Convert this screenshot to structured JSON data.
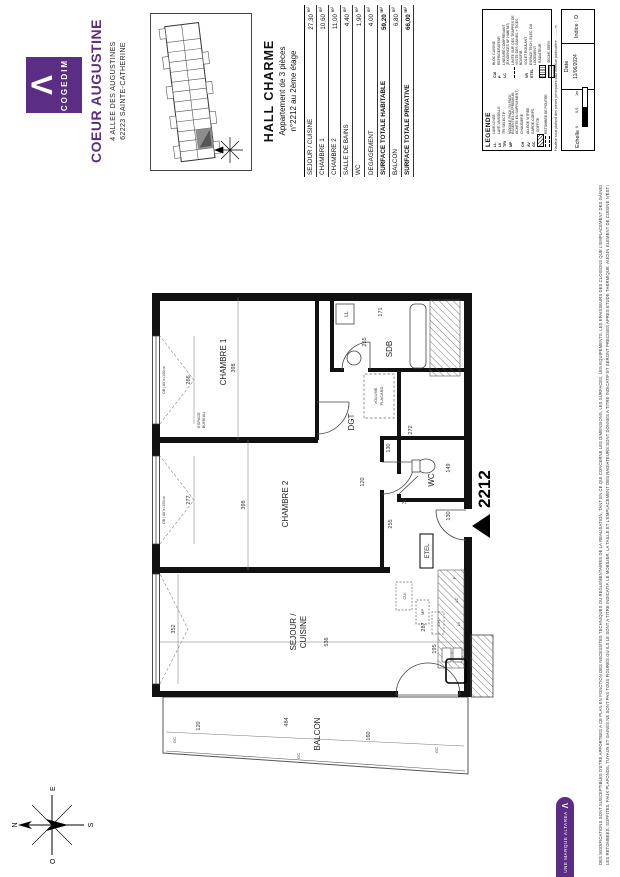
{
  "brand": {
    "name": "COGEDIM",
    "logo_glyph": "Λ",
    "residence": "COEUR AUGUSTINE",
    "address1": "4 ALLEE DES AUGUSTINES",
    "address2": "62223 SAINTE-CATHERINE",
    "ribbon": "UNE MARQUE ALTAREA",
    "accent": "#5b2d85"
  },
  "apartment": {
    "hall": "HALL CHARME",
    "type": "Appartement de 3 pièces",
    "location": "n°2212 au 2ème étage",
    "number": "2212"
  },
  "areas": {
    "unit": "m²",
    "rows": [
      {
        "label": "SEJOUR / CUISINE",
        "value": "27,30"
      },
      {
        "label": "CHAMBRE 1",
        "value": "10,60"
      },
      {
        "label": "CHAMBRE 2",
        "value": "11,00"
      },
      {
        "label": "SALLE DE BAINS",
        "value": "4,40"
      },
      {
        "label": "WC",
        "value": "1,90"
      },
      {
        "label": "DEGAGEMENT",
        "value": "4,00"
      },
      {
        "label": "SURFACE TOTALE HABITABLE",
        "value": "59,20"
      },
      {
        "label": "BALCON",
        "value": "6,80"
      },
      {
        "label": "SURFACE TOTALE PRIVATIVE",
        "value": "66,00"
      }
    ]
  },
  "plan": {
    "rooms": {
      "chambre1": "CHAMBRE 1",
      "chambre2": "CHAMBRE 2",
      "sejour1": "SEJOUR /",
      "sejour2": "CUISINE",
      "sdb": "SDB",
      "dgt": "DGT",
      "wc": "WC",
      "balcon": "BALCON"
    },
    "labels": {
      "espace1": "ESPACE",
      "espace2": "BUREAU",
      "volume1": "VOLUME",
      "volume2": "PLACARD",
      "etel": "ETEL",
      "cui": "CUI",
      "mp": "MP",
      "ch": "CH",
      "lv": "LV",
      "lc": "LC",
      "p": "P",
      "ll": "LL",
      "gc": "GC",
      "window": "OB | AV h=100cm"
    },
    "dims": {
      "d352": "352",
      "d277": "277",
      "d266": "266",
      "d398a": "398",
      "d398b": "398",
      "d536": "536",
      "d287": "287",
      "d195": "195",
      "d255a": "255",
      "d171": "171",
      "d272": "272",
      "d149": "149",
      "d130a": "130",
      "d130b": "130",
      "d120a": "120",
      "d120b": "120",
      "d255b": "255",
      "d30": "30",
      "d484": "484",
      "d160": "160"
    },
    "compass": {
      "n": "N",
      "s": "S",
      "e": "E",
      "o": "O"
    }
  },
  "legend": {
    "title": "LEGENDE",
    "note": "Hauteur sous plafond des pièces principales sauf mention particulière : ........ m",
    "left": [
      {
        "abbr": "LL",
        "label": "LAVE-LINGE"
      },
      {
        "abbr": "LV",
        "label": "LAVE-VAISSELLE"
      },
      {
        "abbr": "TRI",
        "label": "TRI SELECTIF"
      },
      {
        "abbr": "MP",
        "label": "MODULE PACK (SI PACK ESSENTIEL OU PREMIUM ACHETE EN SUPPLEMENT)"
      },
      {
        "abbr": "CH",
        "label": "CHAUDIERE"
      },
      {
        "abbr": "AV",
        "label": "ALLEGE VITREE"
      },
      {
        "abbr": "GC",
        "label": "GARDE-CORPS"
      },
      {
        "abbr": "",
        "label": "SOFFITE"
      },
      {
        "abbr": "",
        "label": "RETOMBEE DE POUTRE"
      }
    ],
    "right": [
      {
        "abbr": "CUI",
        "label": "BLOC CUISINE"
      },
      {
        "abbr": "P",
        "label": "REFRIGERATEUR"
      },
      {
        "abbr": "LC",
        "label": "LINEAIRE COMPRENANT (EXIGENCES NF HABITAT)"
      },
      {
        "abbr": "",
        "label": "LIMITE SUP. DES TRAPPES DE VISITE DES GAINES + TIGES BOIS/FIB."
      },
      {
        "abbr": "VR",
        "label": "VOLET ROULANT"
      },
      {
        "abbr": "ETEL",
        "label": "ESPACE TECH. ELEC. DU LOGEMENT"
      },
      {
        "abbr": "",
        "label": "RADIATEUR"
      },
      {
        "abbr": "",
        "label": "SECHE-SERV."
      }
    ]
  },
  "titleblock": {
    "scale_label": "Echelle",
    "ticks": [
      "0",
      "0,5",
      "1m"
    ],
    "date_label": "Date",
    "date": "11/06/2024",
    "index": "Indice : D"
  },
  "disclaimer": {
    "line1": "DES MODIFICATIONS SONT SUSCEPTIBLES D'ETRE APPORTEES A CE PLAN EN FONCTION DES NECESSITES TECHNIQUES OU REGLEMENTAIRES DE LA REALISATION, TANT EN CE QUI CONCERNE LES DIMENSIONS, LES SURFACES, LES EQUIPEMENTS, LES EPAISSEURS DES CLOISONS QUE L'EMPLACEMENT DES GAINES. LES HAUTEURS DE SEUILS OU D'ALLEGES INDIQUEES SONT APPROXIMATIVES.",
    "line2": "LES RETOMBEES, SOFFITES, FAUX PLAFONDS, TUYAUX ET GAINES NE SONT PAS TOUS FIGURES OU ILS LE SONT A TITRE INDICATIF. LE MOBILIER, LA TAILLE ET L'EMPLACEMENT DES RADIATEURS SONT DONNES A TITRE INDICATIF ET SERONT PRECISES APRES ETUDE THERMIQUE. AUCUN ELEMENT DE CUISINE N'EST FOURNI HORS ACHAT PACK."
  }
}
